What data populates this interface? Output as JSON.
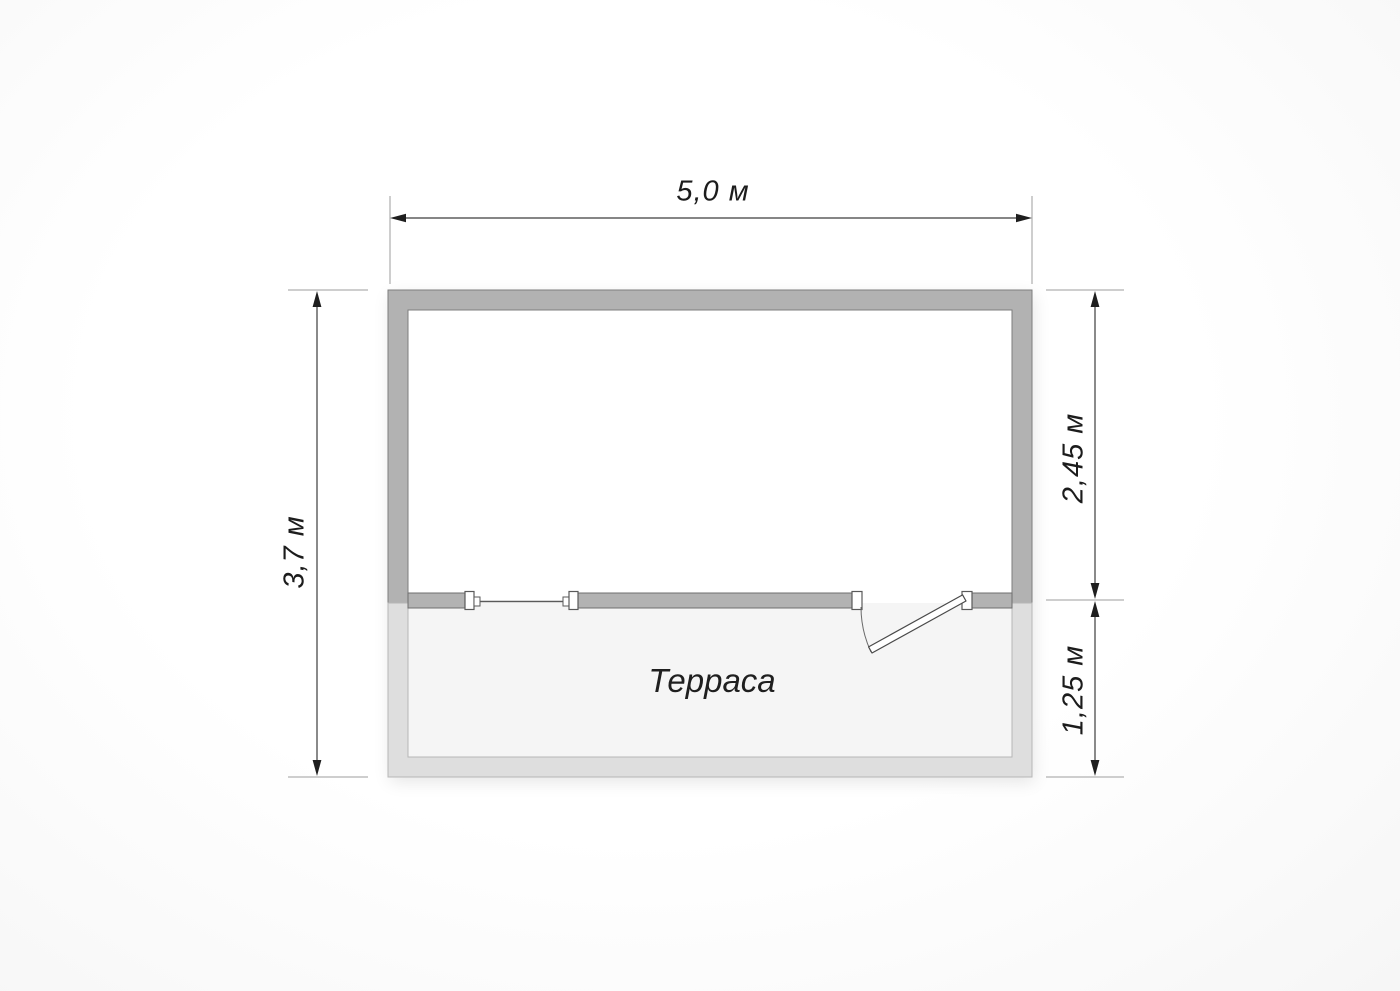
{
  "plan": {
    "rooms": {
      "terrace": {
        "label": "Терраса"
      }
    },
    "dimensions": {
      "width": {
        "label": "5,0 м",
        "side": "top"
      },
      "height": {
        "label": "3,7 м",
        "side": "left"
      },
      "room_depth": {
        "label": "2,45 м",
        "side": "right-upper"
      },
      "terrace_depth": {
        "label": "1,25 м",
        "side": "right-lower"
      }
    },
    "symbols": {
      "window": "window-opening-symbol",
      "door": "swing-door-symbol"
    },
    "colors": {
      "wall_main": "#b2b2b2",
      "wall_main_outline": "#7d7d7d",
      "wall_terrace": "#dedede",
      "wall_terrace_outline": "#b7b7b7",
      "terrace_floor": "#f5f5f5",
      "dimension_line": "#3d3d3d",
      "extension_line": "#9e9e9e",
      "arrow": "#1e1e1e",
      "text": "#1c1c1c",
      "background": "#fbfbfb"
    }
  }
}
